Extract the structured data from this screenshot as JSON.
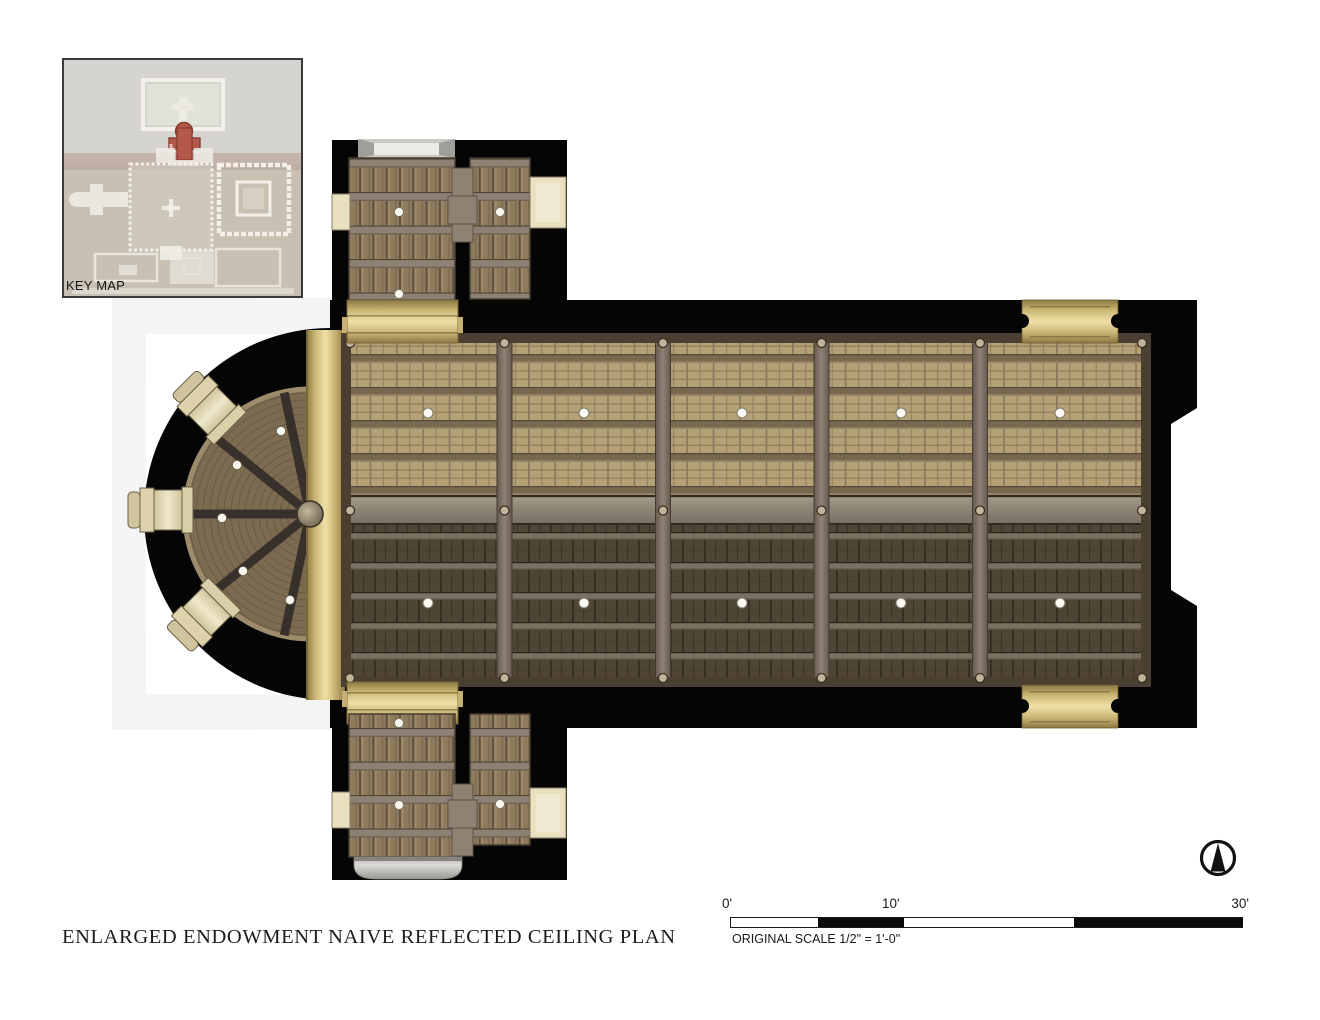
{
  "title": {
    "text": "ENLARGED ENDOWMENT NAIVE REFLECTED CEILING PLAN"
  },
  "key_map": {
    "label": "KEY MAP"
  },
  "scale_bar": {
    "tick_labels": [
      "0'",
      "10'",
      "30'"
    ],
    "caption": "ORIGINAL SCALE 1/2\" = 1'-0\""
  },
  "plan": {
    "nave_bays": 5,
    "nave_light_rows": 2,
    "nave_lights_per_row": 5,
    "apse_lights": 5,
    "apse_niches": 3,
    "transept_lights_top": 3,
    "transept_lights_bottom": 3
  },
  "palette": {
    "page_bg": "#ffffff",
    "wall_black": "#050505",
    "wood_light": "#b4a276",
    "wood_dark": "#4f4535",
    "transept_wood": "#8e7b5e",
    "fan_wood": "#7c6b51",
    "spine_gray": "#8e8477",
    "beam_gray": "#8d8175",
    "gold_light": "#eee0a6",
    "gold_dark": "#8c7843",
    "cream_niche": "#e8e0bf",
    "light_dot": "#fbfaf2",
    "keymap_bg": "#d6d4d1",
    "keymap_tan": "#c8c0b2",
    "keymap_red": "#b3584a",
    "keymap_green": "#dfe3d8"
  }
}
